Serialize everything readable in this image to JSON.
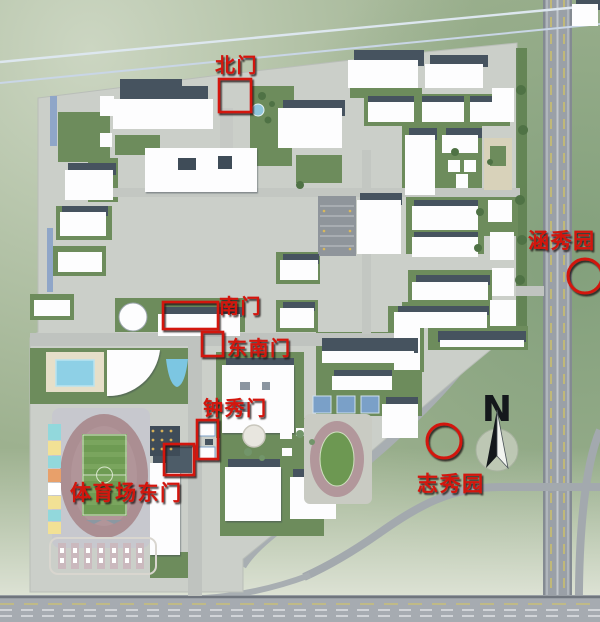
{
  "map": {
    "type": "campus-3d-map",
    "compass": {
      "letter": "N"
    },
    "labels": {
      "north_gate": "北门",
      "south_gate": "南门",
      "southeast_gate": "东南门",
      "zhongxiu_gate": "钟秀门",
      "stadium_east_gate": "体育场东门",
      "hanxiu_garden": "涵秀园",
      "zhixiu_garden": "志秀园"
    },
    "colors": {
      "annotation_red": "#d31510",
      "compass_black": "#14181c",
      "lawn_green": "#6d8c5c",
      "track_rose": "#ab8e92",
      "pool_blue": "#8ed0e6",
      "road_gray": "#9aa0a7"
    }
  }
}
